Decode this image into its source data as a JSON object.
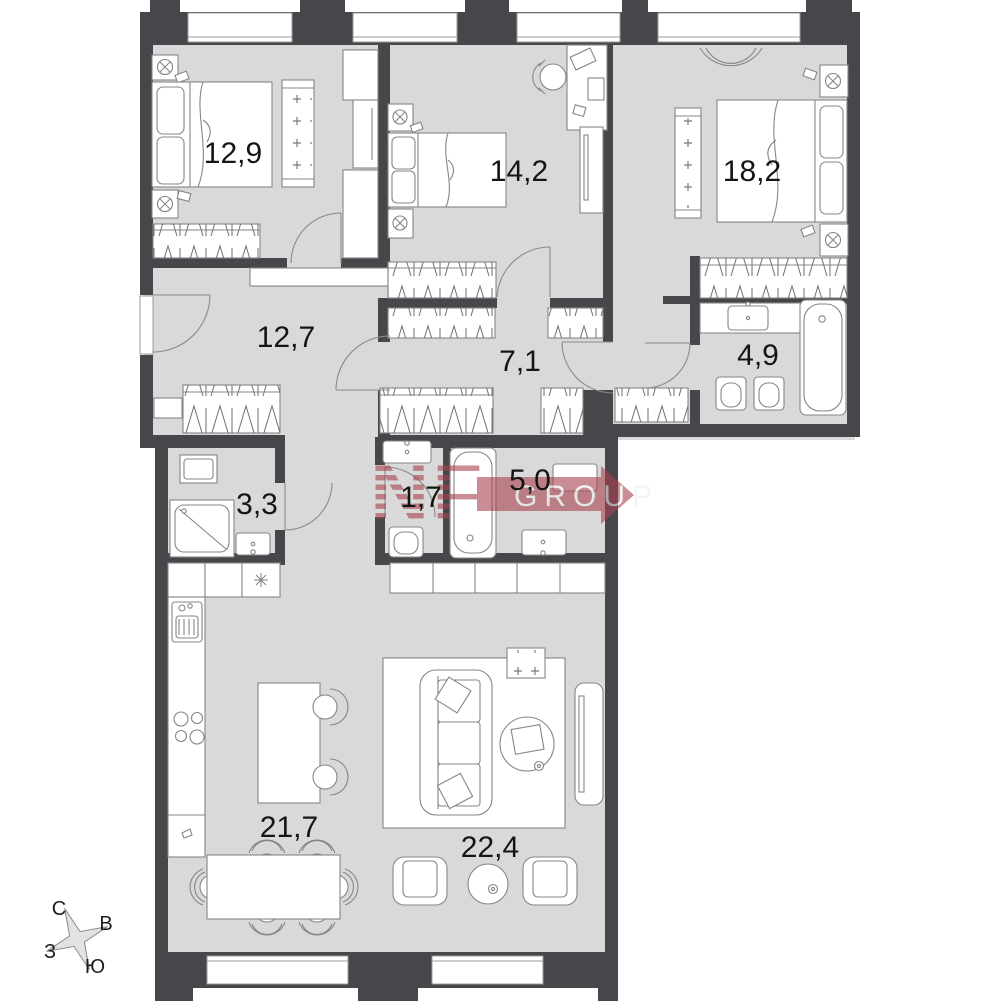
{
  "plan": {
    "rooms": [
      {
        "id": "bedroom-1",
        "area_label": "12,9"
      },
      {
        "id": "bedroom-2",
        "area_label": "14,2"
      },
      {
        "id": "bedroom-3",
        "area_label": "18,2"
      },
      {
        "id": "hallway",
        "area_label": "12,7"
      },
      {
        "id": "corridor",
        "area_label": "7,1"
      },
      {
        "id": "bathroom-main",
        "area_label": "4,9"
      },
      {
        "id": "laundry",
        "area_label": "3,3"
      },
      {
        "id": "wc",
        "area_label": "1,7"
      },
      {
        "id": "bathroom-second",
        "area_label": "5,0"
      },
      {
        "id": "kitchen-dining",
        "area_label": "21,7"
      },
      {
        "id": "living-room",
        "area_label": "22,4"
      }
    ],
    "compass": {
      "north": "С",
      "east": "В",
      "west": "З",
      "south": "Ю"
    },
    "watermark": {
      "brand": "NF",
      "suffix": "GROUP"
    },
    "colors": {
      "wall": "#47474b",
      "floor": "#d9d9d9",
      "furniture_line": "#868686",
      "label": "#151515",
      "watermark_red": "#a8424f"
    }
  }
}
